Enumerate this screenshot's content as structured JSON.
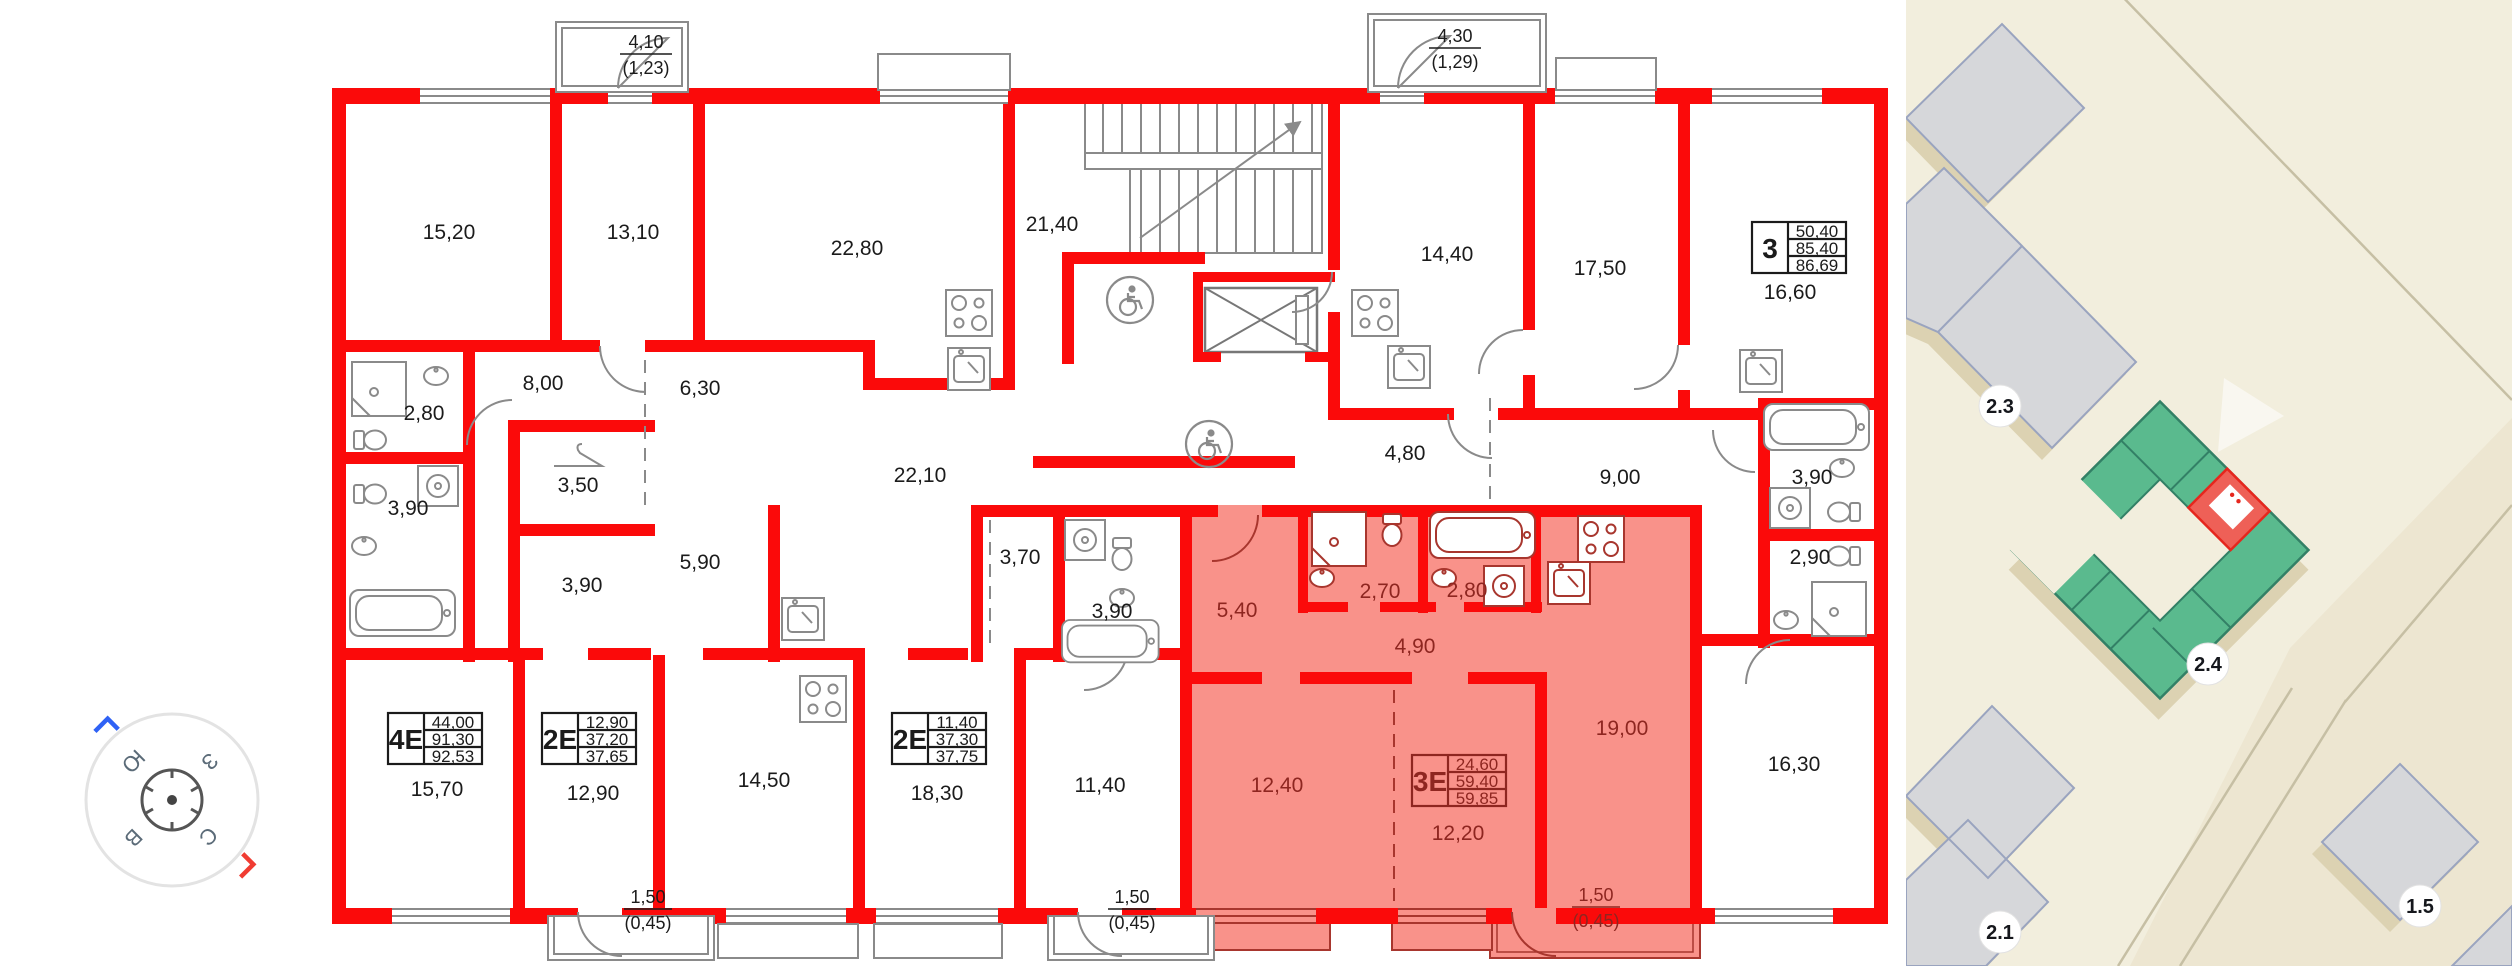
{
  "plan": {
    "wall_color": "#fb0a0a",
    "highlight_fill": "#f9928a",
    "highlight_text_color": "#8e2620",
    "line_color": "#8a8a8a",
    "rooms": [
      {
        "label": "15,20"
      },
      {
        "label": "13,10"
      },
      {
        "label": "22,80"
      },
      {
        "label": "21,40"
      },
      {
        "label": "14,40"
      },
      {
        "label": "17,50"
      },
      {
        "label": "16,60"
      },
      {
        "label": "2,80"
      },
      {
        "label": "8,00"
      },
      {
        "label": "6,30"
      },
      {
        "label": "3,90"
      },
      {
        "label": "3,50"
      },
      {
        "label": "22,10"
      },
      {
        "label": "4,80"
      },
      {
        "label": "9,00"
      },
      {
        "label": "3,90"
      },
      {
        "label": "2,90"
      },
      {
        "label": "3,90"
      },
      {
        "label": "5,90"
      },
      {
        "label": "3,70"
      },
      {
        "label": "3,90"
      },
      {
        "label": "15,70"
      },
      {
        "label": "12,90"
      },
      {
        "label": "14,50"
      },
      {
        "label": "18,30"
      },
      {
        "label": "11,40"
      },
      {
        "label": "16,30"
      }
    ],
    "rooms_highlighted": [
      {
        "label": "5,40"
      },
      {
        "label": "2,70"
      },
      {
        "label": "2,80"
      },
      {
        "label": "4,90"
      },
      {
        "label": "19,00"
      },
      {
        "label": "12,40"
      },
      {
        "label": "12,20"
      }
    ],
    "balconies": [
      {
        "area": "4,10",
        "reduced": "(1,23)"
      },
      {
        "area": "4,30",
        "reduced": "(1,29)"
      },
      {
        "area": "1,50",
        "reduced": "(0,45)"
      },
      {
        "area": "1,50",
        "reduced": "(0,45)"
      },
      {
        "area": "1,50",
        "reduced": "(0,45)"
      }
    ],
    "apartments": [
      {
        "type": "4Е",
        "v1": "44,00",
        "v2": "91,30",
        "v3": "92,53"
      },
      {
        "type": "2Е",
        "v1": "12,90",
        "v2": "37,20",
        "v3": "37,65"
      },
      {
        "type": "2Е",
        "v1": "11,40",
        "v2": "37,30",
        "v3": "37,75"
      },
      {
        "type": "3Е",
        "v1": "24,60",
        "v2": "59,40",
        "v3": "59,85",
        "highlighted": true
      },
      {
        "type": "3",
        "v1": "50,40",
        "v2": "85,40",
        "v3": "86,69"
      }
    ]
  },
  "compass": {
    "letters": {
      "north": "С",
      "south": "Ю",
      "east": "В",
      "west": "З"
    },
    "letter_color": "#5b6b78",
    "north_mark_color": "#f03c32",
    "south_mark_color": "#2f62f5"
  },
  "map": {
    "badges": [
      {
        "label": "2.3"
      },
      {
        "label": "2.4"
      },
      {
        "label": "2.1"
      },
      {
        "label": "1.5"
      }
    ],
    "colors": {
      "background": "#f2eedd",
      "parcel": "#ede6d1",
      "road_line": "#c6bfa4",
      "building_gray": "#d6d7da",
      "building_stroke": "#9aa4bf",
      "shadow": "#dcd2b2",
      "building_green": "#5aba8e",
      "green_stroke": "#338066",
      "unit_red": "#ee6057",
      "red_stroke": "#e6261d"
    }
  }
}
